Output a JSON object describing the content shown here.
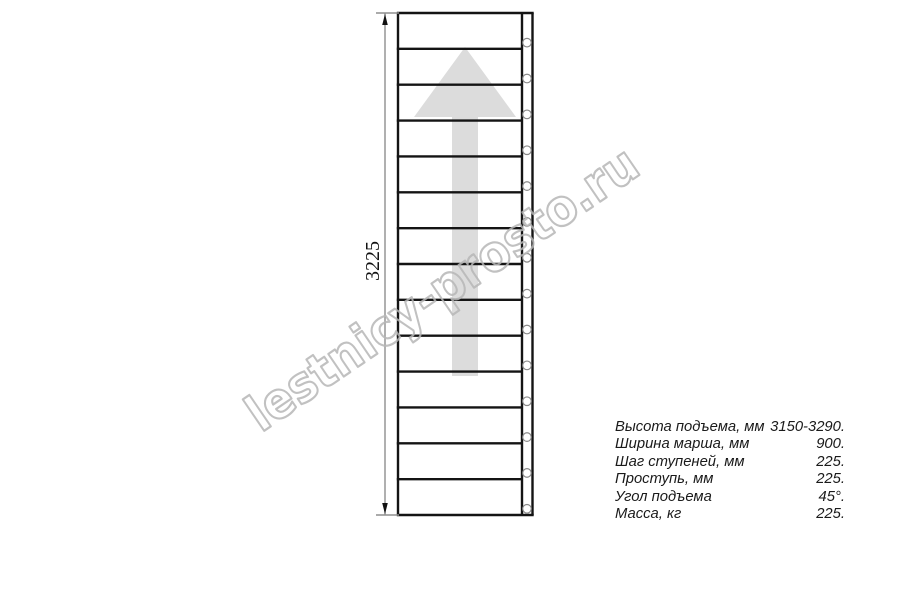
{
  "drawing": {
    "dimension_label": "3225",
    "steps_count": 14,
    "fasteners_count": 14,
    "arrow_direction": "up"
  },
  "watermark": {
    "text": "lestnicy-prosto.ru"
  },
  "specs": {
    "rows": [
      {
        "label": "Высота подъема, мм",
        "value": "3150-3290."
      },
      {
        "label": "Ширина марша, мм",
        "value": "900."
      },
      {
        "label": "Шаг ступеней, мм",
        "value": "225."
      },
      {
        "label": "Проступь, мм",
        "value": "225."
      },
      {
        "label": "Угол подъема",
        "value": "45°."
      },
      {
        "label": "Масса, кг",
        "value": "225."
      }
    ]
  },
  "colors": {
    "stair_line": "#141414",
    "dimension_line": "#8f8f8f",
    "dimension_arrow": "#111111",
    "fastener_stroke": "#8a8a8a",
    "direction_arrow_fill": "#dcdcdc",
    "watermark_stroke": "#b7b7b7",
    "spec_text": "#1a1a1a"
  }
}
